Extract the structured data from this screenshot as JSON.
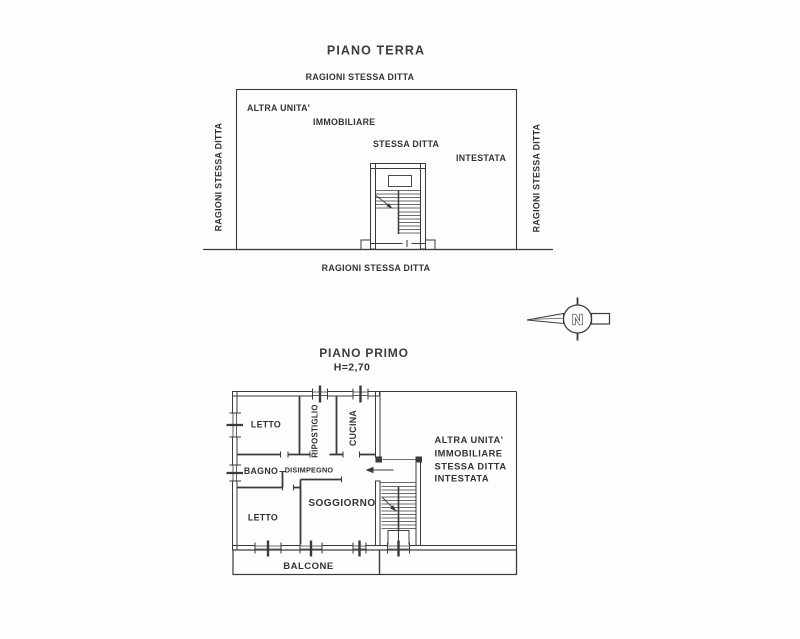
{
  "colors": {
    "ink": "#3a3a3a",
    "paper": "#fdfdfb"
  },
  "ground_floor": {
    "title": "PIANO TERRA",
    "boundary_labels": {
      "top": "RAGIONI STESSA DITTA",
      "left": "RAGIONI STESSA DITTA",
      "right": "RAGIONI STESSA DITTA",
      "bottom": "RAGIONI STESSA DITTA"
    },
    "interior_labels": [
      "ALTRA UNITA'",
      "IMMOBILIARE",
      "STESSA DITTA",
      "INTESTATA"
    ]
  },
  "compass": {
    "letter": "N"
  },
  "first_floor": {
    "title": "PIANO PRIMO",
    "height_label": "H=2,70",
    "rooms": {
      "letto_top": "LETTO",
      "ripostiglio": "RIPOSTIGLIO",
      "cucina": "CUCINA",
      "bagno": "BAGNO",
      "disimpegno": "DISIMPEGNO",
      "soggiorno": "SOGGIORNO",
      "letto_bottom": "LETTO",
      "balcone": "BALCONE"
    },
    "adjacent_unit_labels": [
      "ALTRA UNITA'",
      "IMMOBILIARE",
      "STESSA DITTA",
      "INTESTATA"
    ]
  }
}
